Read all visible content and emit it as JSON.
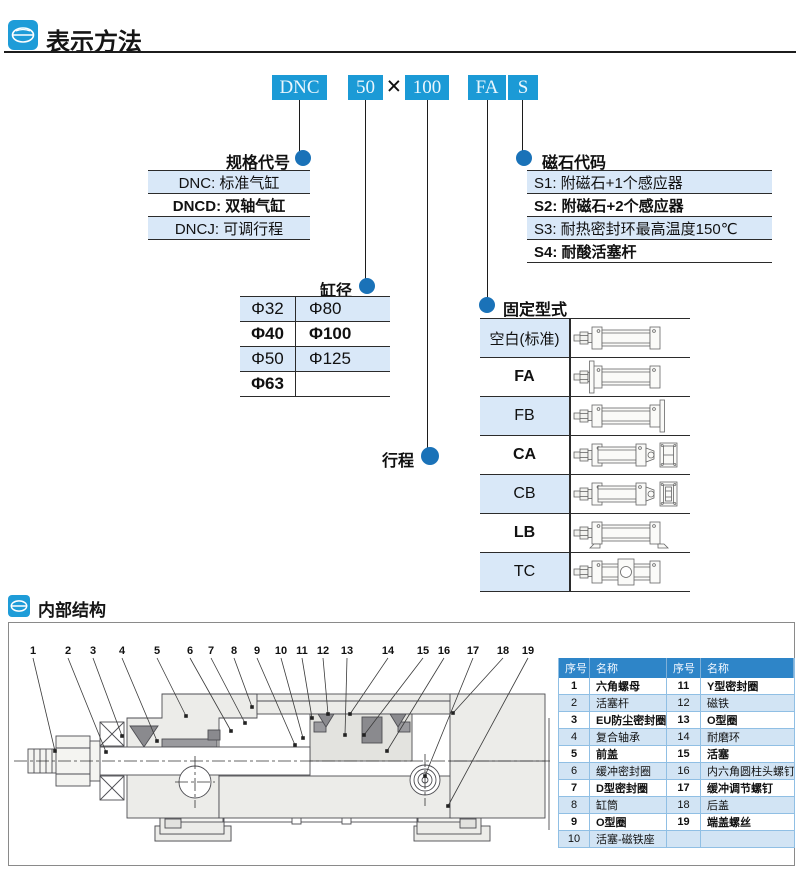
{
  "colors": {
    "box_blue": "#1b9ad6",
    "dot_blue": "#1a72b8",
    "row_light_blue": "#d9e8f8",
    "table_header_blue": "#2e85c8",
    "parts_row_blue": "#d2e4f4"
  },
  "sections": {
    "method_title": "表示方法",
    "structure_title": "内部结构"
  },
  "model_code": {
    "series": "DNC",
    "bore": "50",
    "multiply": "×",
    "stroke": "100",
    "mount": "FA",
    "magnet": "S"
  },
  "spec_code": {
    "label": "规格代号",
    "rows": [
      {
        "text": "DNC: 标准气缸",
        "bold": false
      },
      {
        "text": "DNCD: 双轴气缸",
        "bold": true
      },
      {
        "text": "DNCJ: 可调行程",
        "bold": false
      }
    ]
  },
  "magnet_code": {
    "label": "磁石代码",
    "rows": [
      {
        "text": "S1: 附磁石+1个感应器",
        "bold": false
      },
      {
        "text": "S2: 附磁石+2个感应器",
        "bold": true
      },
      {
        "text": "S3: 耐热密封环最高温度150℃",
        "bold": false
      },
      {
        "text": "S4: 耐酸活塞杆",
        "bold": true
      }
    ]
  },
  "bore_table": {
    "label": "缸径",
    "rows": [
      {
        "c1": "Φ32",
        "c2": "Φ80",
        "bold": false
      },
      {
        "c1": "Φ40",
        "c2": "Φ100",
        "bold": true
      },
      {
        "c1": "Φ50",
        "c2": "Φ125",
        "bold": false
      },
      {
        "c1": "Φ63",
        "c2": "",
        "bold": true
      }
    ]
  },
  "stroke_label": "行程",
  "mounting": {
    "label": "固定型式",
    "rows": [
      {
        "text": "空白(标准)",
        "type": "blank",
        "bold": false
      },
      {
        "text": "FA",
        "type": "FA",
        "bold": true
      },
      {
        "text": "FB",
        "type": "FB",
        "bold": false
      },
      {
        "text": "CA",
        "type": "CA",
        "bold": true
      },
      {
        "text": "CB",
        "type": "CB",
        "bold": false
      },
      {
        "text": "LB",
        "type": "LB",
        "bold": true
      },
      {
        "text": "TC",
        "type": "TC",
        "bold": false
      }
    ]
  },
  "parts_table": {
    "headers": [
      "序号",
      "名称",
      "序号",
      "名称"
    ],
    "rows": [
      [
        "1",
        "六角螺母",
        "11",
        "Y型密封圈"
      ],
      [
        "2",
        "活塞杆",
        "12",
        "磁铁"
      ],
      [
        "3",
        "EU防尘密封圈",
        "13",
        "O型圈"
      ],
      [
        "4",
        "复合轴承",
        "14",
        "耐磨环"
      ],
      [
        "5",
        "前盖",
        "15",
        "活塞"
      ],
      [
        "6",
        "缓冲密封圈",
        "16",
        "内六角圆柱头螺钉"
      ],
      [
        "7",
        "D型密封圈",
        "17",
        "缓冲调节螺钉"
      ],
      [
        "8",
        "缸筒",
        "18",
        "后盖"
      ],
      [
        "9",
        "O型圈",
        "19",
        "端盖螺丝"
      ],
      [
        "10",
        "活塞-磁铁座",
        "",
        ""
      ]
    ]
  },
  "drawing": {
    "callouts": [
      "1",
      "2",
      "3",
      "4",
      "5",
      "6",
      "7",
      "8",
      "9",
      "10",
      "11",
      "12",
      "13",
      "14",
      "15",
      "16",
      "17",
      "18",
      "19"
    ]
  }
}
